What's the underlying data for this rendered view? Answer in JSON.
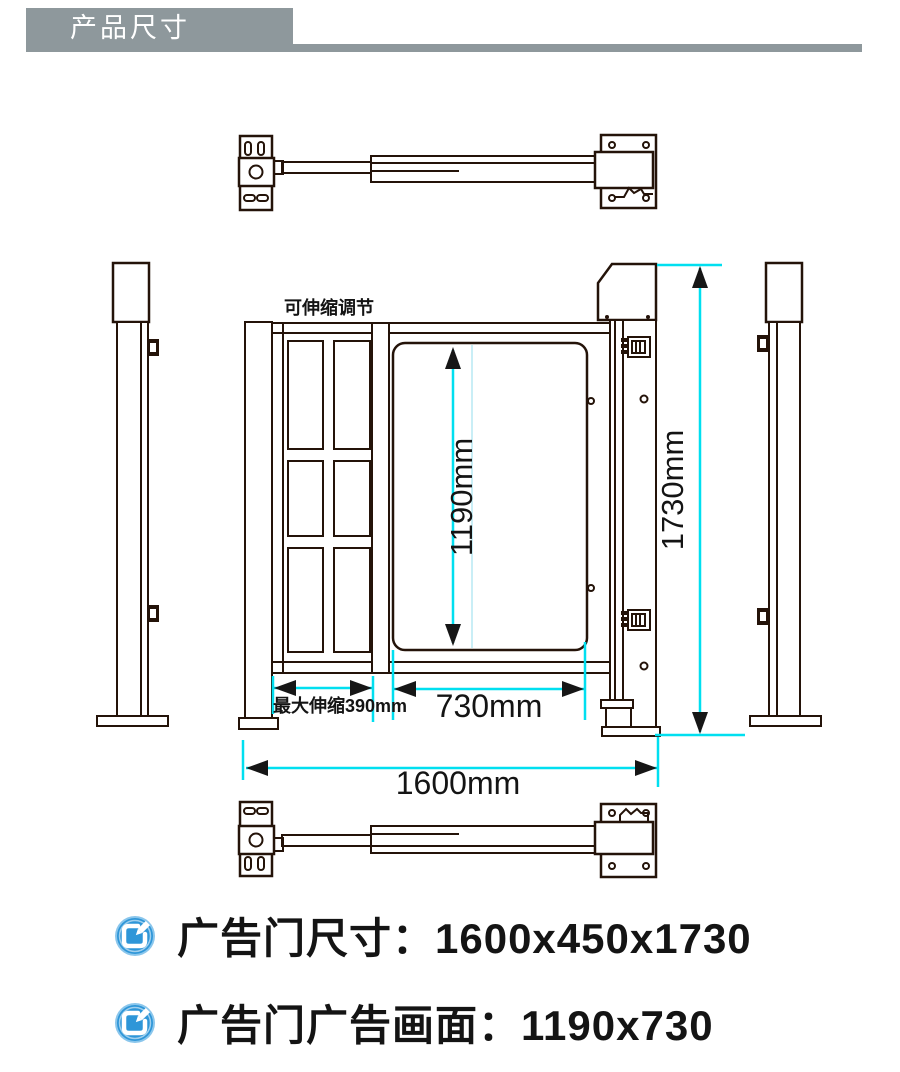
{
  "header": {
    "title": "产品尺寸"
  },
  "diagram": {
    "note_telescopic": "可伸缩调节",
    "dim_panel_height": "1190mm",
    "dim_total_height": "1730mm",
    "dim_panel_width": "730mm",
    "dim_total_width": "1600mm",
    "dim_max_extension": "最大伸缩390mm",
    "colors": {
      "line": "#241309",
      "dim": "#00dff0",
      "dim-faint": "#c9eef6",
      "banner": "#8e989c",
      "icon-blue": "#2e96d8",
      "icon-ring": "#8ac6ec",
      "text": "#141414"
    }
  },
  "specs": {
    "items": [
      {
        "text": "广告门尺寸：1600x450x1730"
      },
      {
        "text": "广告门广告画面：1190x730"
      }
    ]
  }
}
